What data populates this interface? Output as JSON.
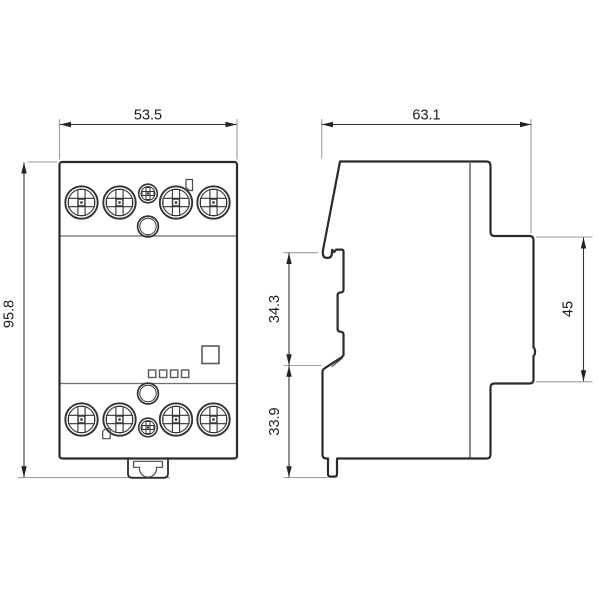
{
  "drawing": {
    "views": {
      "front": {
        "label": "front-view"
      },
      "side": {
        "label": "side-view"
      }
    },
    "dimensions": {
      "front_width": "53.5",
      "front_height": "95.8",
      "side_depth": "63.1",
      "upper_rail_offset": "34.3",
      "lower_rail_offset": "33.9",
      "rear_section_height": "45"
    },
    "colors": {
      "outline": "#2b2b2b",
      "detail_line": "#4a4a4a",
      "divider": "#6e6e6e",
      "dimension_line": "#333333",
      "extension_line": "#9e9e9e",
      "arrow": "#222222",
      "text": "#1a1a1a",
      "background": "#ffffff"
    }
  }
}
